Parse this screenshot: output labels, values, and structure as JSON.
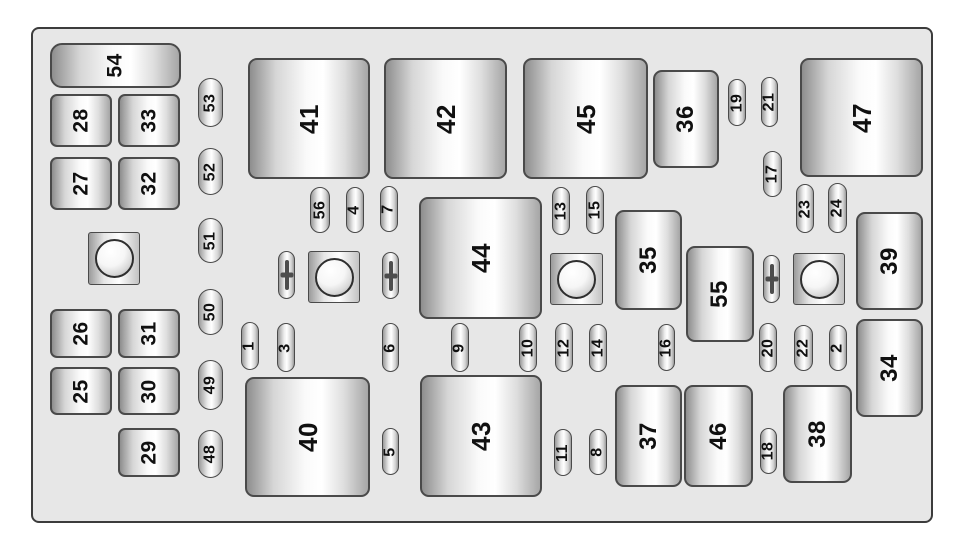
{
  "diagram_title": "Fuse box layout diagram",
  "colors": {
    "page_bg": "#ffffff",
    "board_bg": "#e7e7e7",
    "board_border": "#3c3c3c",
    "element_border": "#4a4a4a",
    "label_color": "#101010"
  },
  "board": {
    "x": 31,
    "y": 27,
    "w": 902,
    "h": 496,
    "elements": [
      {
        "label": "54",
        "type": "wide",
        "x": 50,
        "y": 43,
        "w": 131,
        "h": 45
      },
      {
        "label": "28",
        "type": "square",
        "x": 50,
        "y": 94,
        "w": 62,
        "h": 53
      },
      {
        "label": "33",
        "type": "square",
        "x": 118,
        "y": 94,
        "w": 62,
        "h": 53
      },
      {
        "label": "27",
        "type": "square",
        "x": 50,
        "y": 157,
        "w": 62,
        "h": 53
      },
      {
        "label": "32",
        "type": "square",
        "x": 118,
        "y": 157,
        "w": 62,
        "h": 53
      },
      {
        "label": "26",
        "type": "square",
        "x": 50,
        "y": 309,
        "w": 62,
        "h": 49
      },
      {
        "label": "31",
        "type": "square",
        "x": 118,
        "y": 309,
        "w": 62,
        "h": 49
      },
      {
        "label": "25",
        "type": "square",
        "x": 50,
        "y": 367,
        "w": 62,
        "h": 48
      },
      {
        "label": "30",
        "type": "square",
        "x": 118,
        "y": 367,
        "w": 62,
        "h": 48
      },
      {
        "label": "29",
        "type": "square",
        "x": 118,
        "y": 428,
        "w": 62,
        "h": 49
      },
      {
        "label": "53",
        "type": "pill-lg",
        "x": 198,
        "y": 78,
        "w": 25,
        "h": 49
      },
      {
        "label": "52",
        "type": "pill-lg",
        "x": 198,
        "y": 148,
        "w": 25,
        "h": 47
      },
      {
        "label": "51",
        "type": "pill-lg",
        "x": 198,
        "y": 218,
        "w": 25,
        "h": 45
      },
      {
        "label": "50",
        "type": "pill-lg",
        "x": 198,
        "y": 289,
        "w": 25,
        "h": 46
      },
      {
        "label": "49",
        "type": "pill-lg",
        "x": 198,
        "y": 360,
        "w": 25,
        "h": 50
      },
      {
        "label": "48",
        "type": "pill-lg",
        "x": 198,
        "y": 430,
        "w": 25,
        "h": 48
      },
      {
        "label": "41",
        "type": "relay",
        "x": 248,
        "y": 58,
        "w": 122,
        "h": 121
      },
      {
        "label": "42",
        "type": "relay",
        "x": 384,
        "y": 58,
        "w": 123,
        "h": 121
      },
      {
        "label": "45",
        "type": "relay",
        "x": 523,
        "y": 58,
        "w": 125,
        "h": 121
      },
      {
        "label": "47",
        "type": "relay",
        "x": 800,
        "y": 58,
        "w": 123,
        "h": 119
      },
      {
        "label": "44",
        "type": "relay",
        "x": 419,
        "y": 197,
        "w": 123,
        "h": 122
      },
      {
        "label": "40",
        "type": "relay",
        "x": 245,
        "y": 377,
        "w": 125,
        "h": 120
      },
      {
        "label": "43",
        "type": "relay",
        "x": 420,
        "y": 375,
        "w": 122,
        "h": 122
      },
      {
        "label": "36",
        "type": "block",
        "x": 653,
        "y": 70,
        "w": 66,
        "h": 98
      },
      {
        "label": "35",
        "type": "block",
        "x": 615,
        "y": 210,
        "w": 67,
        "h": 100
      },
      {
        "label": "55",
        "type": "block",
        "x": 686,
        "y": 246,
        "w": 68,
        "h": 96
      },
      {
        "label": "39",
        "type": "block",
        "x": 856,
        "y": 212,
        "w": 67,
        "h": 98
      },
      {
        "label": "34",
        "type": "block",
        "x": 856,
        "y": 319,
        "w": 67,
        "h": 98
      },
      {
        "label": "37",
        "type": "block",
        "x": 615,
        "y": 385,
        "w": 67,
        "h": 102
      },
      {
        "label": "46",
        "type": "block",
        "x": 684,
        "y": 385,
        "w": 69,
        "h": 102
      },
      {
        "label": "38",
        "type": "block",
        "x": 783,
        "y": 385,
        "w": 69,
        "h": 98
      },
      {
        "label": "56",
        "type": "pill",
        "x": 310,
        "y": 187,
        "w": 20,
        "h": 46
      },
      {
        "label": "4",
        "type": "pill",
        "x": 346,
        "y": 187,
        "w": 18,
        "h": 46
      },
      {
        "label": "7",
        "type": "pill",
        "x": 380,
        "y": 186,
        "w": 18,
        "h": 46
      },
      {
        "label": "13",
        "type": "pill",
        "x": 552,
        "y": 187,
        "w": 18,
        "h": 48
      },
      {
        "label": "15",
        "type": "pill",
        "x": 586,
        "y": 186,
        "w": 18,
        "h": 48
      },
      {
        "label": "19",
        "type": "pill",
        "x": 728,
        "y": 79,
        "w": 18,
        "h": 47
      },
      {
        "label": "21",
        "type": "pill",
        "x": 761,
        "y": 77,
        "w": 17,
        "h": 50
      },
      {
        "label": "17",
        "type": "pill",
        "x": 763,
        "y": 151,
        "w": 19,
        "h": 46
      },
      {
        "label": "23",
        "type": "pill",
        "x": 796,
        "y": 184,
        "w": 18,
        "h": 49
      },
      {
        "label": "24",
        "type": "pill",
        "x": 828,
        "y": 183,
        "w": 19,
        "h": 50
      },
      {
        "label": "1",
        "type": "pill",
        "x": 241,
        "y": 322,
        "w": 18,
        "h": 48
      },
      {
        "label": "3",
        "type": "pill",
        "x": 277,
        "y": 323,
        "w": 18,
        "h": 49
      },
      {
        "label": "6",
        "type": "pill",
        "x": 382,
        "y": 323,
        "w": 17,
        "h": 49
      },
      {
        "label": "9",
        "type": "pill",
        "x": 451,
        "y": 323,
        "w": 18,
        "h": 49
      },
      {
        "label": "10",
        "type": "pill",
        "x": 519,
        "y": 323,
        "w": 18,
        "h": 49
      },
      {
        "label": "12",
        "type": "pill",
        "x": 555,
        "y": 323,
        "w": 18,
        "h": 49
      },
      {
        "label": "14",
        "type": "pill",
        "x": 589,
        "y": 324,
        "w": 18,
        "h": 48
      },
      {
        "label": "16",
        "type": "pill",
        "x": 658,
        "y": 324,
        "w": 17,
        "h": 47
      },
      {
        "label": "20",
        "type": "pill",
        "x": 759,
        "y": 323,
        "w": 18,
        "h": 49
      },
      {
        "label": "22",
        "type": "pill",
        "x": 794,
        "y": 325,
        "w": 19,
        "h": 46
      },
      {
        "label": "2",
        "type": "pill",
        "x": 829,
        "y": 325,
        "w": 18,
        "h": 46
      },
      {
        "label": "5",
        "type": "pill",
        "x": 382,
        "y": 428,
        "w": 17,
        "h": 47
      },
      {
        "label": "11",
        "type": "pill",
        "x": 554,
        "y": 429,
        "w": 18,
        "h": 47
      },
      {
        "label": "8",
        "type": "pill",
        "x": 589,
        "y": 429,
        "w": 18,
        "h": 46
      },
      {
        "label": "18",
        "type": "pill",
        "x": 760,
        "y": 428,
        "w": 17,
        "h": 46
      },
      {
        "label": "",
        "type": "stud",
        "x": 88,
        "y": 232,
        "w": 52,
        "h": 53
      },
      {
        "label": "",
        "type": "stud",
        "x": 308,
        "y": 251,
        "w": 52,
        "h": 52
      },
      {
        "label": "",
        "type": "stud",
        "x": 550,
        "y": 253,
        "w": 53,
        "h": 52
      },
      {
        "label": "",
        "type": "stud",
        "x": 793,
        "y": 253,
        "w": 52,
        "h": 52
      },
      {
        "label": "",
        "type": "bolt",
        "x": 278,
        "y": 251,
        "w": 17,
        "h": 48
      },
      {
        "label": "",
        "type": "bolt",
        "x": 382,
        "y": 252,
        "w": 17,
        "h": 47
      },
      {
        "label": "",
        "type": "bolt",
        "x": 763,
        "y": 255,
        "w": 17,
        "h": 48
      }
    ]
  }
}
